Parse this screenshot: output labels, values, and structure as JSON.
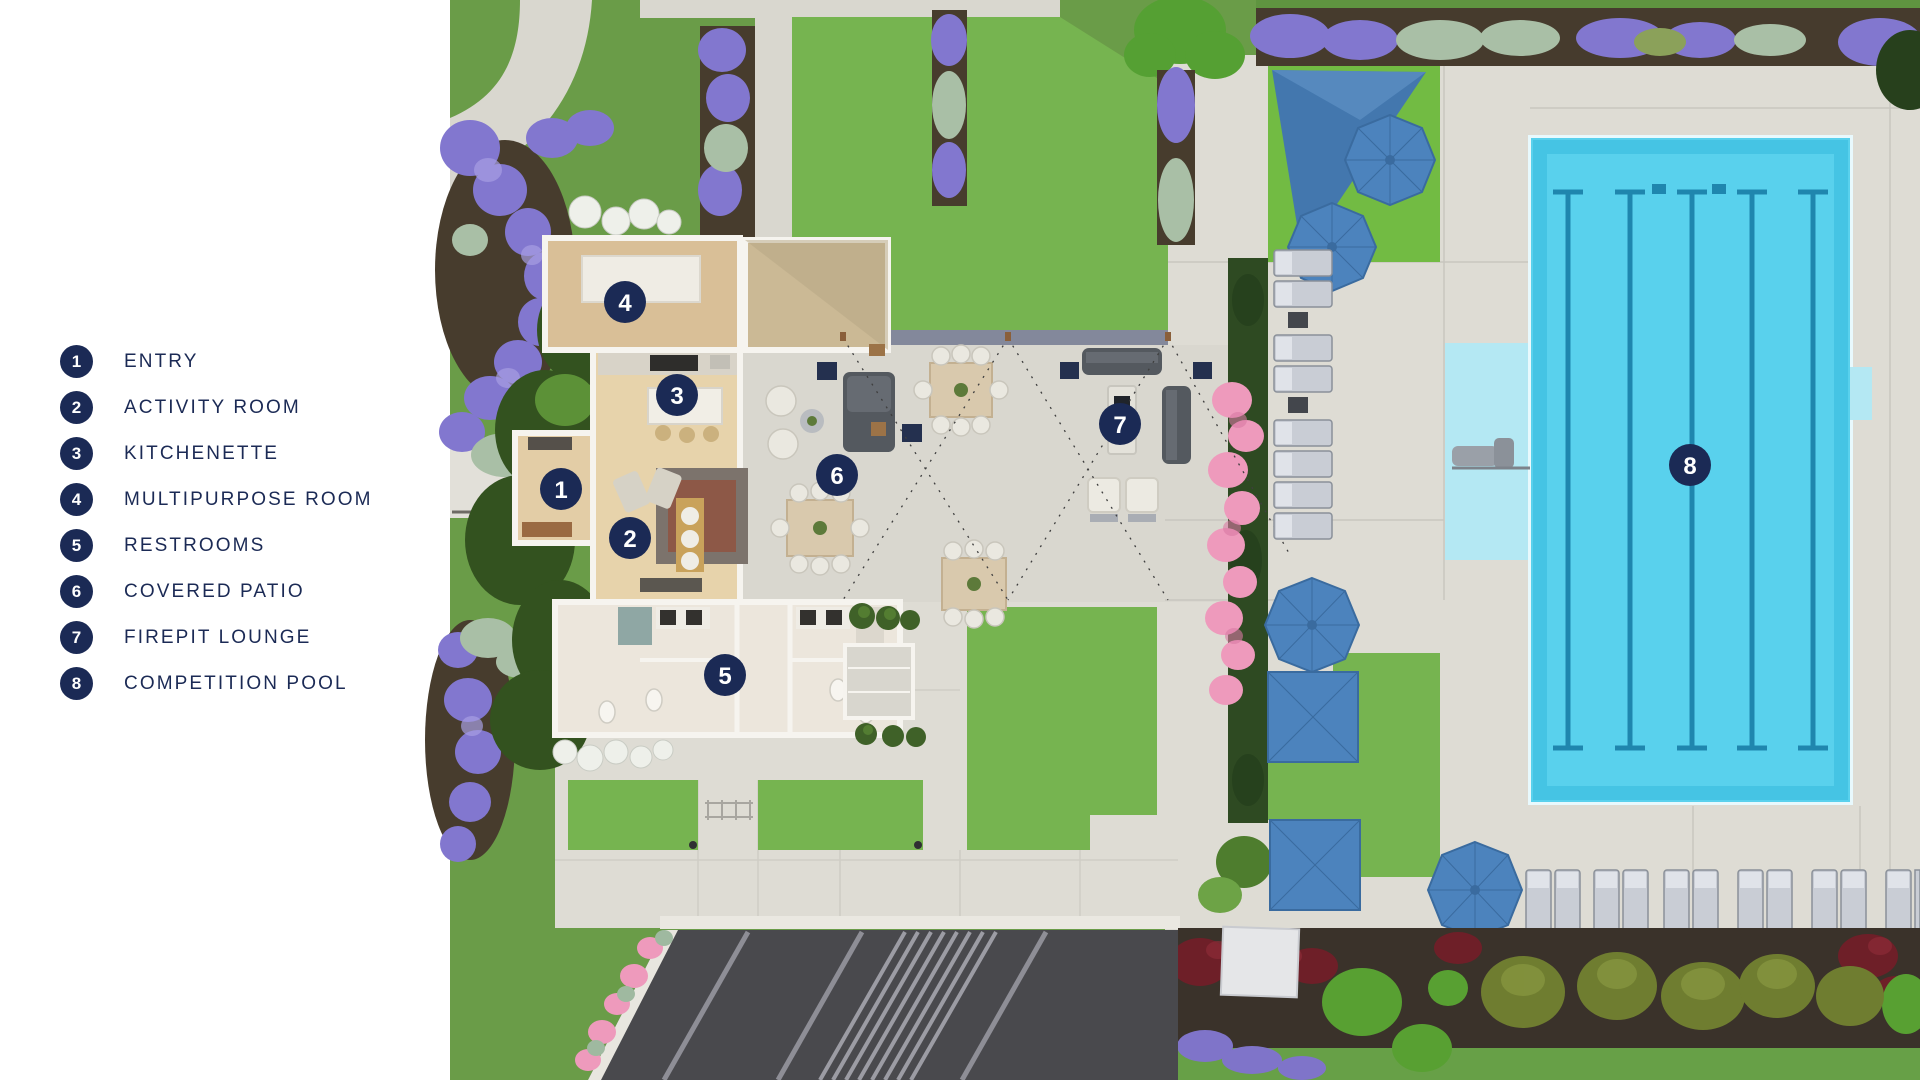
{
  "legend": {
    "items": [
      {
        "number": "1",
        "label": "ENTRY"
      },
      {
        "number": "2",
        "label": "ACTIVITY ROOM"
      },
      {
        "number": "3",
        "label": "KITCHENETTE"
      },
      {
        "number": "4",
        "label": "MULTIPURPOSE ROOM"
      },
      {
        "number": "5",
        "label": "RESTROOMS"
      },
      {
        "number": "6",
        "label": "COVERED PATIO"
      },
      {
        "number": "7",
        "label": "FIREPIT LOUNGE"
      },
      {
        "number": "8",
        "label": "COMPETITION POOL"
      }
    ]
  },
  "plan": {
    "markers": [
      {
        "number": "1",
        "area": "entry"
      },
      {
        "number": "2",
        "area": "activity-room"
      },
      {
        "number": "3",
        "area": "kitchenette"
      },
      {
        "number": "4",
        "area": "multipurpose-room"
      },
      {
        "number": "5",
        "area": "restrooms"
      },
      {
        "number": "6",
        "area": "covered-patio"
      },
      {
        "number": "7",
        "area": "firepit-lounge"
      },
      {
        "number": "8",
        "area": "competition-pool"
      }
    ]
  },
  "colors": {
    "navy": "#1b2a55",
    "pool": "#59d1ed",
    "pool_shallow": "#b4e8f3",
    "lane": "#1f86ae",
    "umbrella": "#4c83bd",
    "grass": "#6fa34b",
    "lawn": "#76b450",
    "hedge": "#2f4d24",
    "concrete": "#d9d7cf",
    "asphalt": "#49494d",
    "purple_flowers": "#8277cf",
    "pink_flowers": "#ee9abc",
    "sage": "#a9bfa6",
    "mulch": "#3a322a",
    "wood_floor": "#dcc39c"
  }
}
